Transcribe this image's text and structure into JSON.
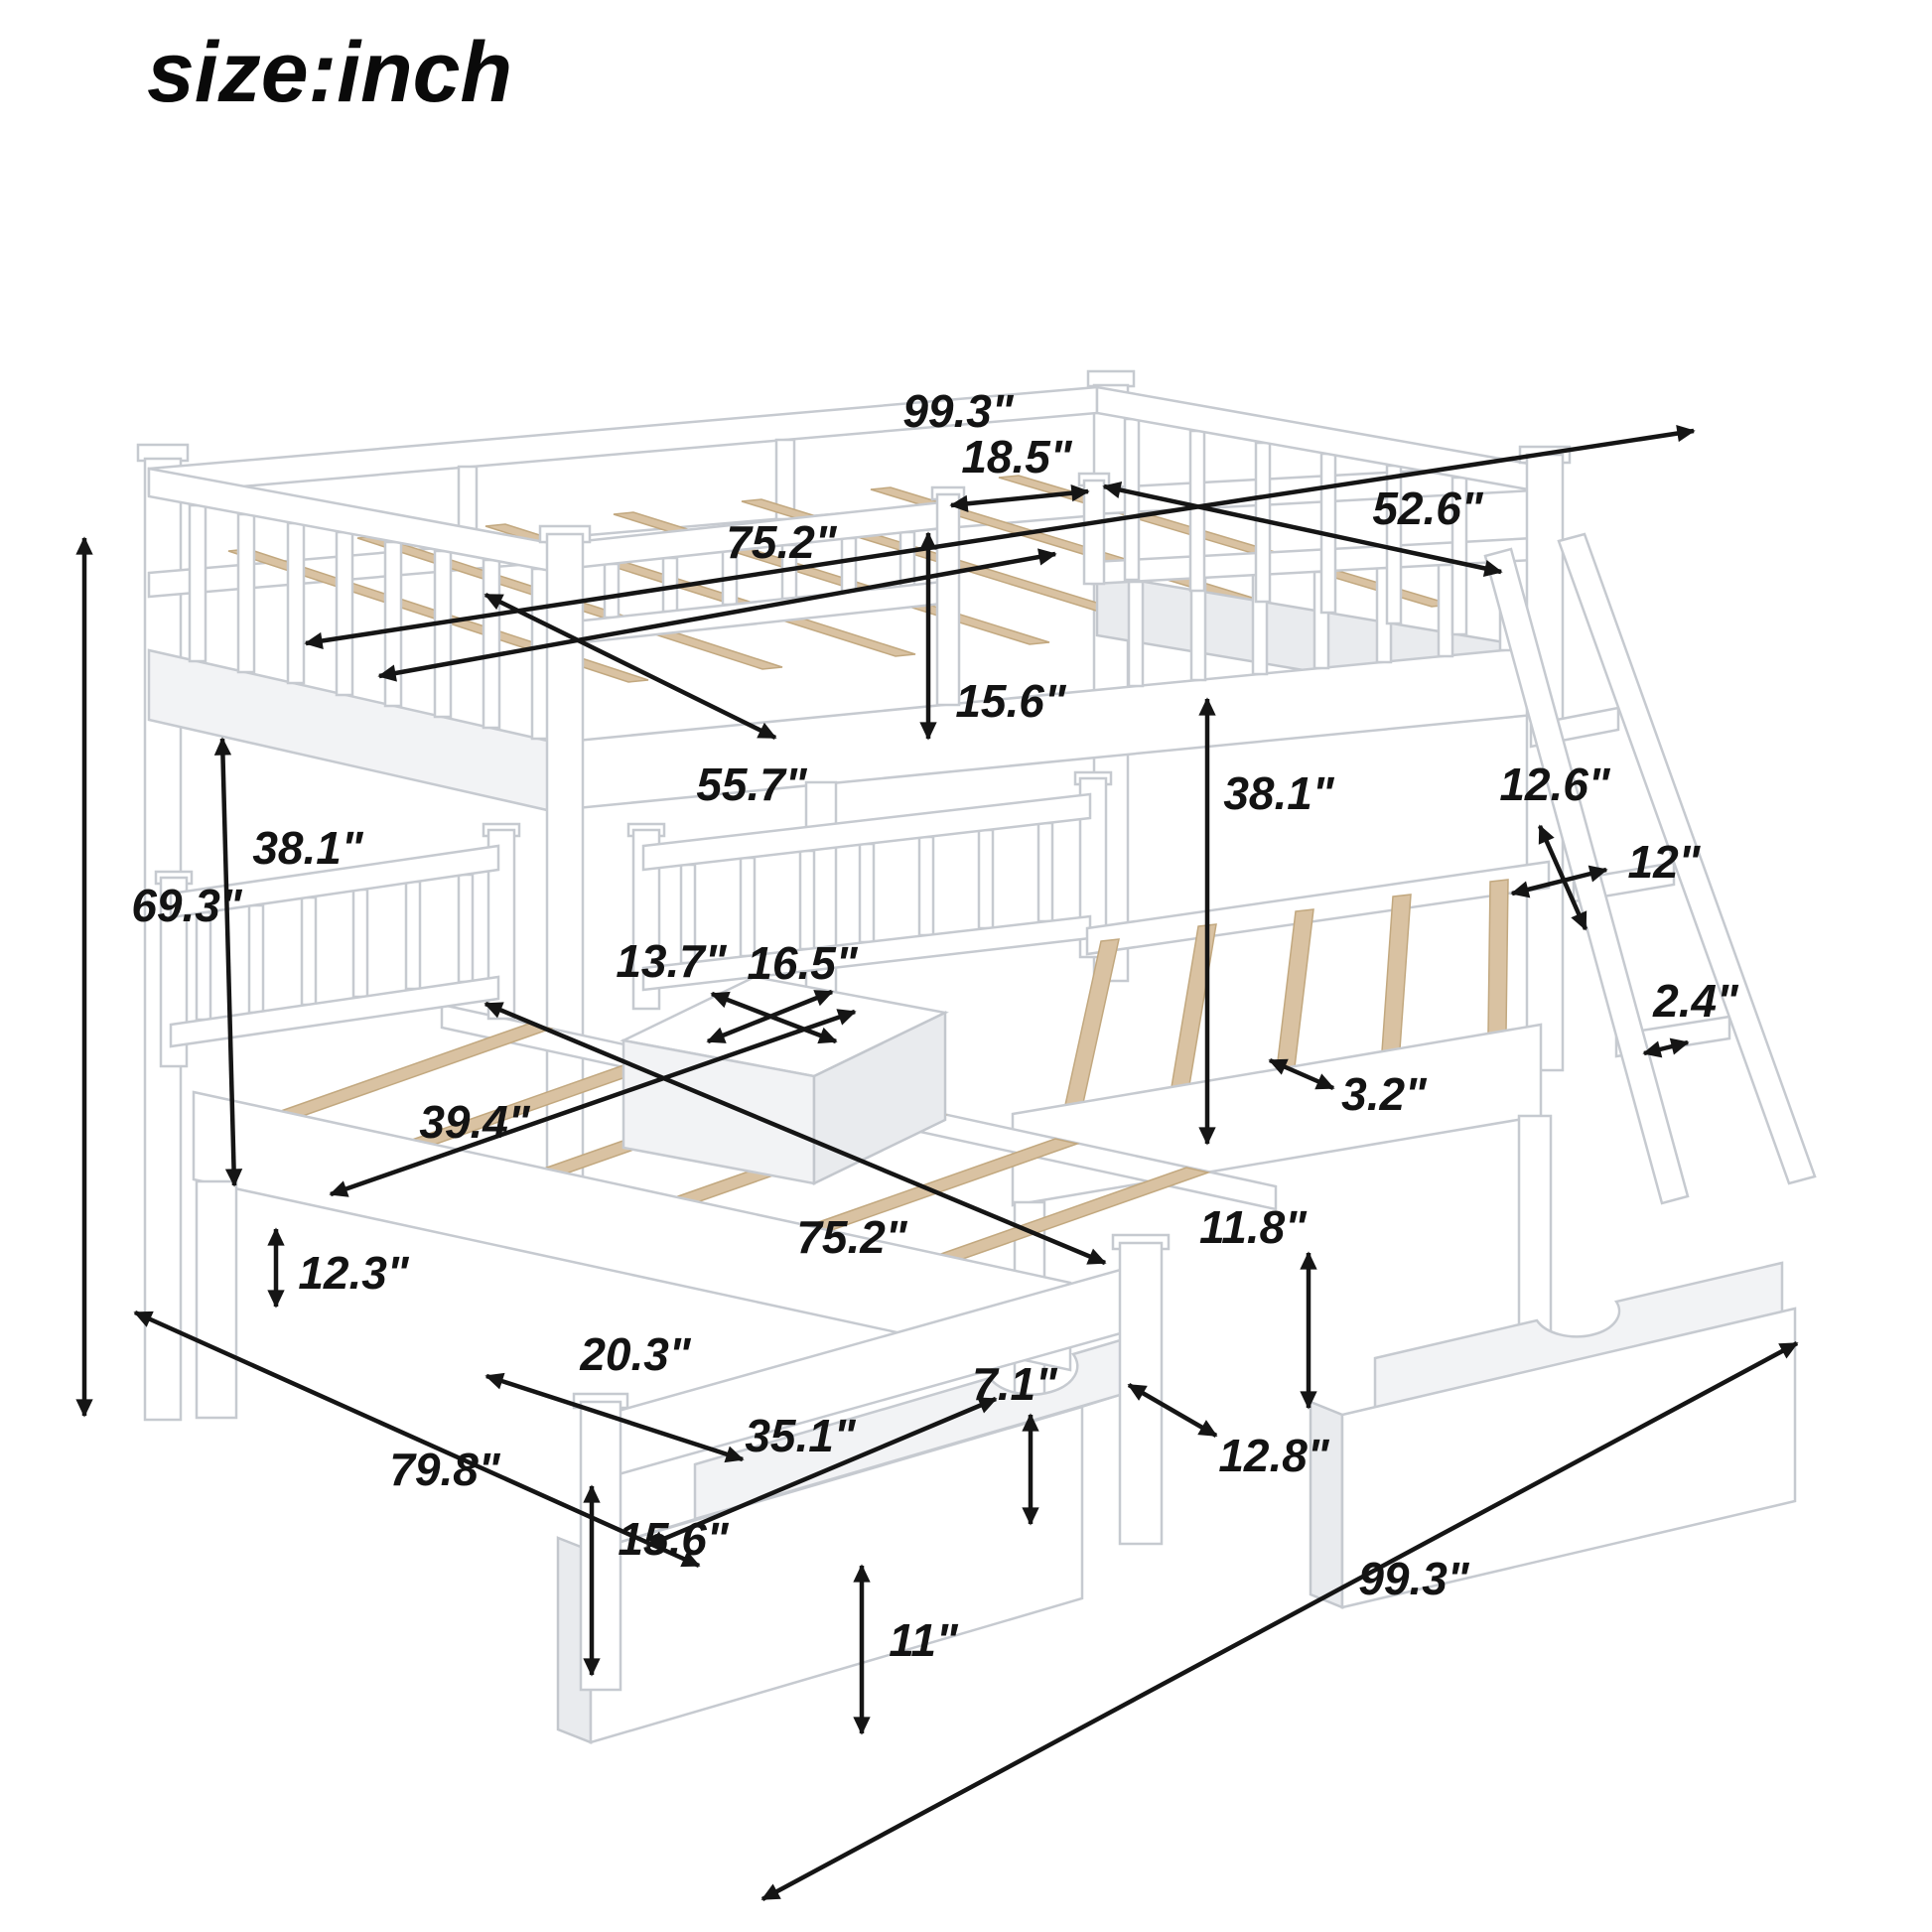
{
  "title": {
    "text": "size:inch"
  },
  "dimensions": {
    "overall_length_top": {
      "text": "99.3\""
    },
    "ladder_opening": {
      "text": "18.5\""
    },
    "top_bed_width": {
      "text": "52.6\""
    },
    "top_bed_inner_length": {
      "text": "75.2\""
    },
    "top_bed_inner_width": {
      "text": "55.7\""
    },
    "top_frame_depth": {
      "text": "15.6\""
    },
    "overall_height": {
      "text": "69.3\""
    },
    "clearance_left": {
      "text": "38.1\""
    },
    "clearance_right": {
      "text": "38.1\""
    },
    "ladder_step_spacing": {
      "text": "12.6\""
    },
    "ladder_width": {
      "text": "12\""
    },
    "ladder_rail_thickness": {
      "text": "2.4\""
    },
    "table_depth": {
      "text": "13.7\""
    },
    "table_width": {
      "text": "16.5\""
    },
    "lower_bed_width": {
      "text": "39.4\""
    },
    "lower_bed_length": {
      "text": "75.2\""
    },
    "slat_width": {
      "text": "3.2\""
    },
    "lower_frame_height": {
      "text": "12.3\""
    },
    "footboard_width": {
      "text": "20.3\""
    },
    "under_bed_clearance": {
      "text": "11.8\""
    },
    "floor_depth": {
      "text": "79.8\""
    },
    "drawer_space_height": {
      "text": "15.6\""
    },
    "drawer_length": {
      "text": "35.1\""
    },
    "drawer_opening_height": {
      "text": "7.1\""
    },
    "drawer_depth": {
      "text": "12.8\""
    },
    "drawer_height": {
      "text": "11\""
    },
    "overall_length_bottom": {
      "text": "99.3\""
    }
  }
}
